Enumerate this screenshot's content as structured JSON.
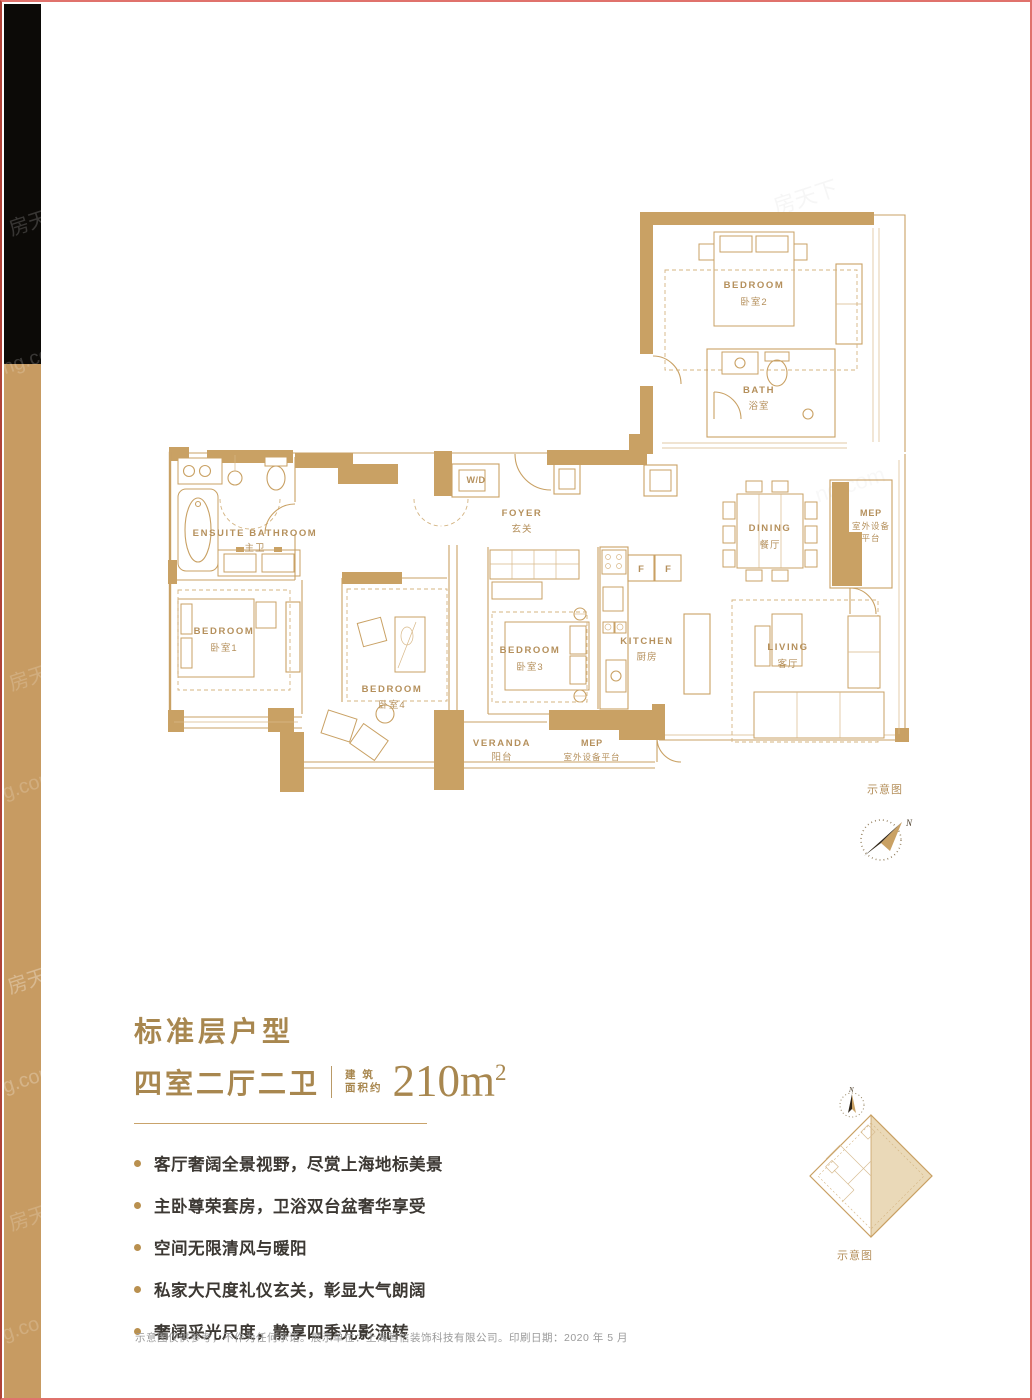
{
  "title": {
    "line1": "标准层户型",
    "line2": "四室二厅二卫",
    "area_label_top": "建 筑",
    "area_label_bottom": "面积约",
    "area_value": "210m",
    "area_sup": "2"
  },
  "features": [
    "客厅奢阔全景视野，尽赏上海地标美景",
    "主卧尊荣套房，卫浴双台盆奢华享受",
    "空间无限清风与暖阳",
    "私家大尺度礼仪玄关，彰显大气朗阔",
    "奢阔采光尺度，静享四季光影流转"
  ],
  "disclaimer": "示意图仅供参考，不作为任何承诺。展示单位：上海哲信装饰科技有限公司。印刷日期：2020 年 5 月",
  "floorplan": {
    "rooms": {
      "bedroom2": {
        "en": "BEDROOM",
        "cn": "卧室2"
      },
      "bath": {
        "en": "BATH",
        "cn": "浴室"
      },
      "ensuite": {
        "en": "ENSUITE BATHROOM",
        "cn": "主卫"
      },
      "bedroom1": {
        "en": "BEDROOM",
        "cn": "卧室1"
      },
      "bedroom4": {
        "en": "BEDROOM",
        "cn": "卧室4"
      },
      "bedroom3": {
        "en": "BEDROOM",
        "cn": "卧室3"
      },
      "wd": {
        "en": "W/D"
      },
      "foyer": {
        "en": "FOYER",
        "cn": "玄关"
      },
      "kitchen": {
        "en": "KITCHEN",
        "cn": "厨房"
      },
      "fridge": "F",
      "dining": {
        "en": "DINING",
        "cn": "餐厅"
      },
      "mep_top": {
        "en": "MEP",
        "cn1": "室外设备",
        "cn2": "平台"
      },
      "living": {
        "en": "LIVING",
        "cn": "客厅"
      },
      "veranda": {
        "en": "VERANDA",
        "cn": "阳台"
      },
      "mep_bottom": {
        "en": "MEP",
        "cn": "室外设备平台"
      }
    },
    "note": "示意图",
    "north": "N"
  },
  "keyplan": {
    "note": "示意图",
    "north": "N"
  },
  "watermarks": [
    "房天",
    "ng.co",
    "房天",
    "g.com",
    "房天下",
    "g.com",
    "房天",
    "g.co",
    "房天下",
    "ng.com"
  ]
}
